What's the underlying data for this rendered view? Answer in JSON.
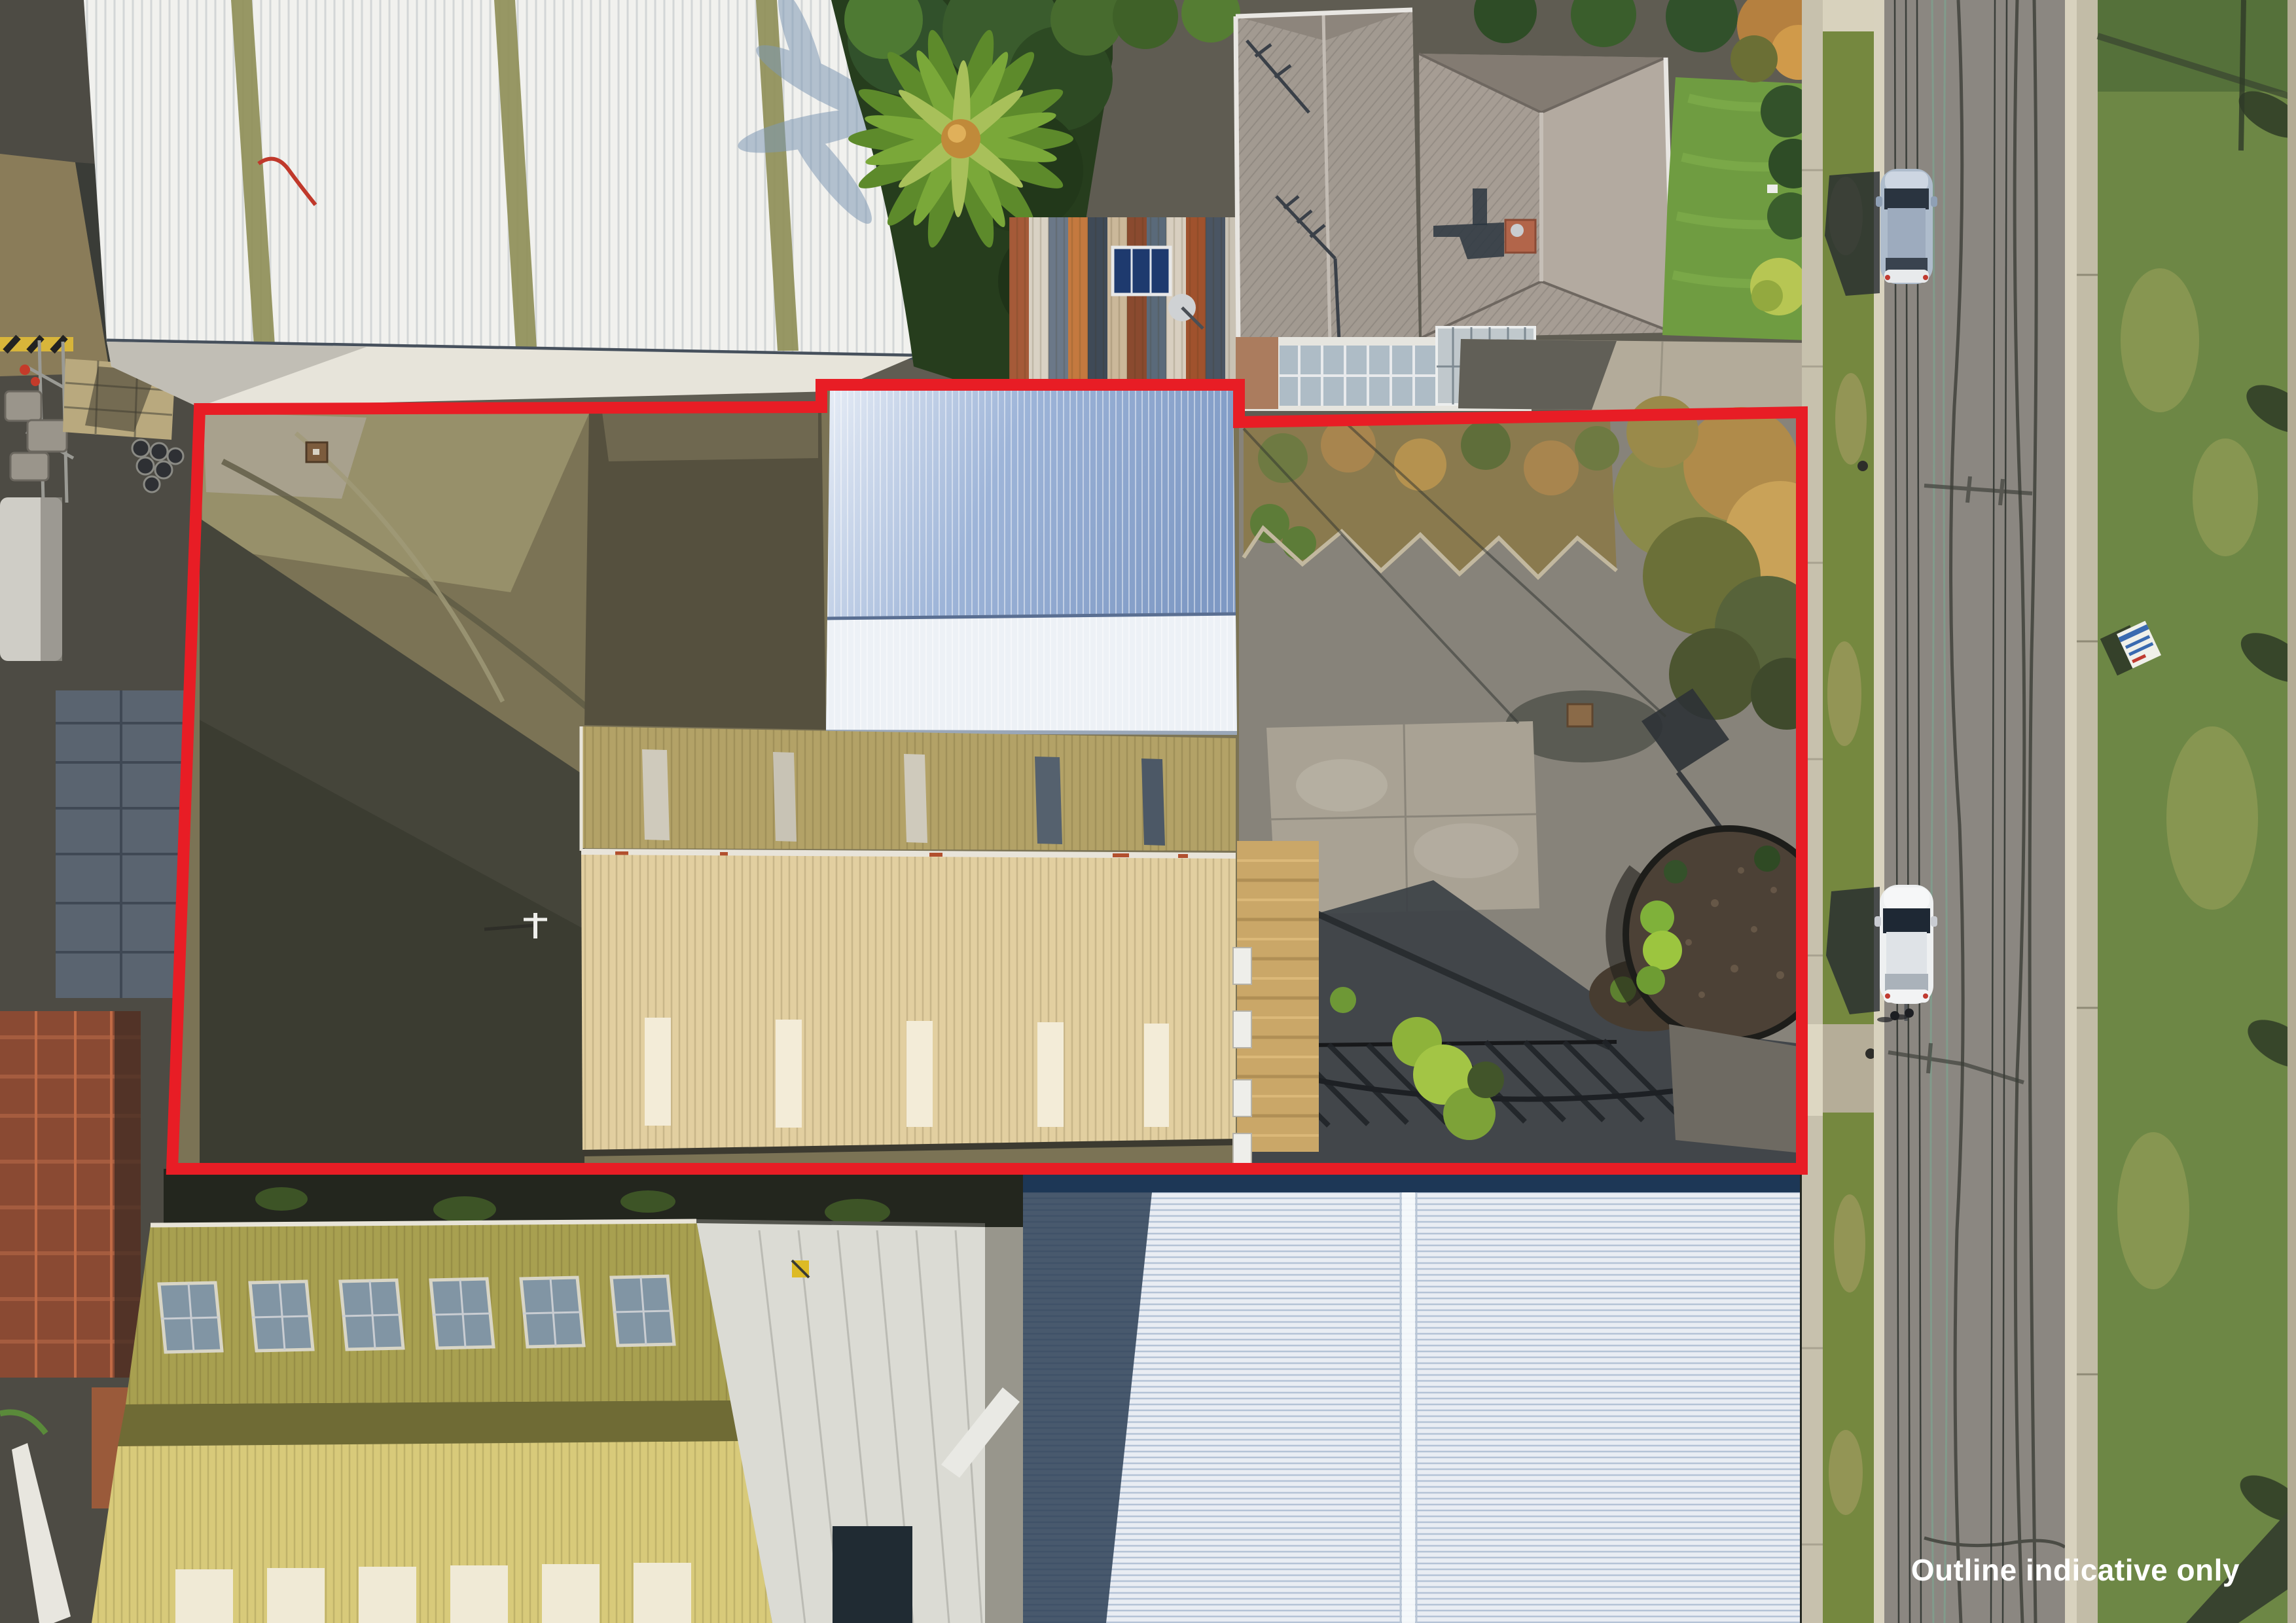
{
  "overlay": {
    "disclaimer": "Outline indicative only"
  },
  "colors": {
    "outline-red": "#e81d25",
    "label-white": "#ffffff",
    "white-roof": "#f1f1ee",
    "skylight-olive": "#8f8f58",
    "blue-roof": "#97aed2",
    "blue-roof-light": "#edf1f6",
    "tan-roof-upper": "#b3a267",
    "tan-roof-lower": "#e2cfa0",
    "house-roof": "#a29a91",
    "yellow-roof-upper": "#a8a050",
    "yellow-roof-lower": "#d8ca7a",
    "bottom-roof-white": "#e9edf3",
    "yard-asphalt": "#87837a",
    "gravel-olive": "#7b7355",
    "dirt": "#8a7c59",
    "road": "#8b8781",
    "kerb": "#d8d2be",
    "footpath": "#c7c1ad",
    "grass-verge": "#75883f",
    "grass-far": "#6d8745",
    "tree-dark": "#263d1d",
    "palm-green": "#6f9a33",
    "autumn-shrub": "#a5854c",
    "mulch": "#4c4136",
    "car-silver": "#aebccc",
    "car-white": "#eef0f1",
    "shadow-dark": "#2b2f31"
  }
}
